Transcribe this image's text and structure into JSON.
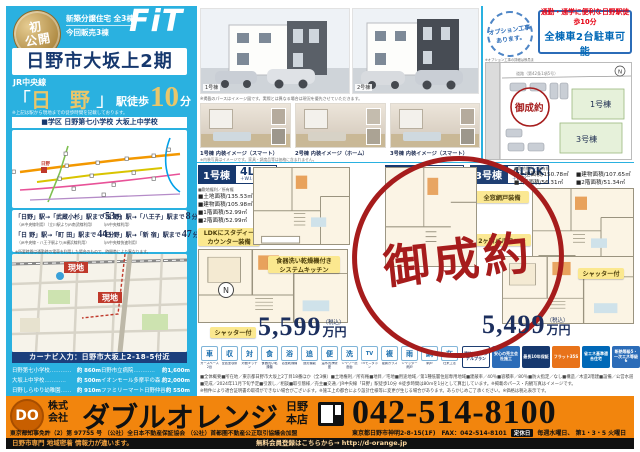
{
  "colors": {
    "cyan": "#2ab1e0",
    "navy": "#16386e",
    "gold": "#e9c66a",
    "red": "#a61c1c",
    "yellow": "#fbe88f",
    "orange": "#f2850d"
  },
  "left": {
    "badge_top": "初",
    "badge_bottom": "公開",
    "catch1": "新築分譲住宅 全3棟",
    "catch2": "今回販売3棟",
    "logo": "FiT",
    "title": "日野市大坂上2期",
    "line_name": "JR中央線",
    "station_open": "「",
    "station_name": "日 野",
    "station_close": "」",
    "walk_prefix": "駅徒歩",
    "walk_min": "10",
    "walk_unit": "分",
    "walk_note": "※上記は駅から現地までの徒歩時間を記載しております。",
    "school": "■学区 日野第七小学校 大坂上中学校",
    "genchi": "現地",
    "navi": "カーナビ入力：日野市大坂上2-18-5付近"
  },
  "routes": {
    "items": [
      {
        "label": "「日野」駅→「武蔵小杉」駅まで",
        "min": "53",
        "unit": "分",
        "note": "（JR中央線利用）（立川駅よりJR南武線利用）"
      },
      {
        "label": "「日 野」駅→「八王子」駅まで",
        "min": "8",
        "unit": "分",
        "note": "（JR中央線利用）"
      },
      {
        "label": "「日 野」駅→「町 田」駅まで",
        "min": "44",
        "unit": "分",
        "note": "（JR中央線・八王子駅よりJR横浜線利用）"
      },
      {
        "label": "「日 野」駅→「新 宿」駅まで",
        "min": "47",
        "unit": "分",
        "note": "（JR中央線快速利用）"
      }
    ],
    "footnote": "※所要時間は通勤時の電車を利用した場合のもので、時間帯により異なります。"
  },
  "distances": [
    {
      "name": "日野第七小学校",
      "dots": "…………",
      "value": "約 860m"
    },
    {
      "name": "日野市立病院",
      "dots": "…………",
      "value": "約1,600m"
    },
    {
      "name": "大坂上中学校",
      "dots": "…………",
      "value": "約 500m"
    },
    {
      "name": "イオンモール多摩平の森",
      "dots": "…",
      "value": "約2,000m"
    },
    {
      "name": "日野しらゆり幼稚園",
      "dots": "……",
      "value": "約 910m"
    },
    {
      "name": "ファミリーマート日野仲谷店",
      "dots": "",
      "value": "約 550m"
    }
  ],
  "top": {
    "stamp1": "オプション工事",
    "stamp2": "あります。",
    "stamp_note": "※オプション工事の詳細は係員までお問い合わせください。",
    "promo1": "通勤・通学に便利な日野駅徒歩10分",
    "promo2": "全棟車2台駐車可能",
    "ext1": "1号棟",
    "ext2": "2号棟",
    "ext_note": "※掲載のパースはイメージ図です。実際とは異なる場合は現況を優先させていただきます。",
    "int_captions": [
      "1号棟 内装イメージ（スマート）",
      "2号棟 内装イメージ（ホーム）",
      "3号棟 内装イメージ（スマート）"
    ],
    "int_note": "※内装写真はイメージです。家具・調度品等は価格に含まれません。",
    "siteplan": {
      "lot1": "1号棟",
      "lot3": "3号棟",
      "sold": "御成約",
      "north": "N",
      "road": "道路（第42条1項5号）"
    }
  },
  "units": {
    "u1": {
      "no": "1号棟",
      "plan": "4LDK",
      "plan_sub": "＋W.I.C",
      "note": "■敷地権利／所有権",
      "areas": [
        "■土地面積/135.53㎡",
        "■建物面積/105.98㎡",
        "■1階面積/52.99㎡",
        "■2階面積/52.99㎡"
      ],
      "feature1a": "LDKにスタディー",
      "feature1b": "カウンター装備",
      "feature2a": "食器洗い乾燥機付き",
      "feature2b": "システムキッチン",
      "shutter": "シャッター付",
      "price": "5,599",
      "tax": "（税込）",
      "price_unit": "万円"
    },
    "u2": {
      "no": "2号棟",
      "plan": "4LDK",
      "plan_sub": "＋W.I.C",
      "sold": "御成約"
    },
    "u3": {
      "no": "3号棟",
      "plan": "4LDK",
      "plan_sub": "＋W.I.C",
      "note": "■敷地権利／所有権",
      "areas": [
        "■土地面積/150.78㎡",
        "■建物面積/107.65㎡",
        "■1階面積/56.31㎡",
        "■2階面積/51.34㎡"
      ],
      "feature1": "全窓網戸装備",
      "feature2": "2ヶ所バルコニー",
      "shutter": "シャッター付",
      "price": "5,499",
      "tax": "（税込）",
      "price_unit": "万円"
    }
  },
  "equipment": {
    "icons": [
      {
        "label": "カースペース2台",
        "glyph": "車"
      },
      {
        "label": "全居室収納",
        "glyph": "収"
      },
      {
        "label": "対面キッチン",
        "glyph": "対"
      },
      {
        "label": "食器洗い乾燥機",
        "glyph": "食"
      },
      {
        "label": "浴室乾燥機",
        "glyph": "浴"
      },
      {
        "label": "追焚機能",
        "glyph": "追"
      },
      {
        "label": "温水洗浄便座",
        "glyph": "便"
      },
      {
        "label": "シャワー洗面台",
        "glyph": "洗"
      },
      {
        "label": "TVモニタホン",
        "glyph": "TV"
      },
      {
        "label": "複層ガラス",
        "glyph": "複"
      },
      {
        "label": "シャッター雨戸",
        "glyph": "雨"
      },
      {
        "label": "網戸",
        "glyph": "網"
      },
      {
        "label": "在来工法",
        "glyph": "在"
      }
    ],
    "badges": [
      {
        "text": "建物はオリジナルプラン"
      },
      {
        "text": "安心の売主会社施工"
      },
      {
        "text": "最長10年保証"
      },
      {
        "text": "フラット35S"
      },
      {
        "text": "省エネ基準適合住宅"
      },
      {
        "text": "断熱等級5・一次エネ等級6"
      }
    ]
  },
  "fineprint": {
    "l1": "■全体概要■所在地／東京都日野市大坂上2丁目18番ほか（全3棟）■土地権利／所有権■地目／宅地■用途地域／第1種低層住居専用地域■建蔽率／40％■容積率／80％■防火指定／なし■構造／木造2階建■設備／公営水道・本下水・都市ガス",
    "l2": "■完成／2024年11月下旬予定■引渡し／相談■取引態様／売主■交通／JR中央線「日野」駅徒歩10分 ※徒歩時間は80ｍを1分として算出しています。※掲載のパース・内観写真はイメージです。",
    "l3": "※物件により適合証明書の取得ができない場合がございます。※施工上の都合により設計仕様等に変更が生じる場合があります。あらかじめご了承ください。※価格は税込表示です。"
  },
  "footer": {
    "logo": "DO",
    "prefix1": "株式",
    "prefix2": "会社",
    "company": "ダブルオレンジ",
    "branch1": "日野",
    "branch2": "本店",
    "license": "東京都知事免許（2）第 97755 号 （公社）全日本不動産保証協会 （公社）首都圏不動産公正取引協議会加盟",
    "tel": "042-514-8100",
    "address": "東京都日野市神明2-8-15(1F)　FAX：042-514-8101",
    "holiday_label": "定休日",
    "holiday": "毎週水曜日、 第1・3・5 火曜日",
    "tagline": "日野市専門 地域密着 情報力が違います。",
    "cta": "無料会員登録はこちらから→ http://d-orange.jp"
  }
}
